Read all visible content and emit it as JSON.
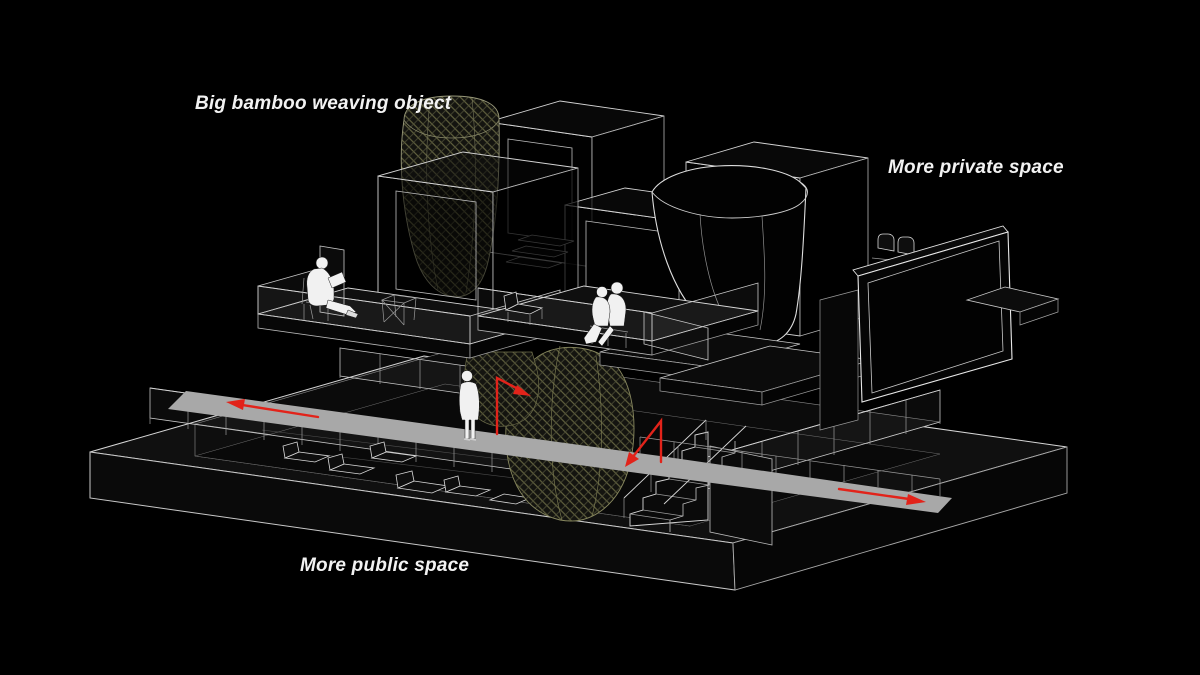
{
  "scene": {
    "type": "axonometric-architecture-diagram",
    "labels": {
      "bamboo_object": "Big bamboo weaving object",
      "private_space": "More private space",
      "public_space": "More public space"
    },
    "colors": {
      "background": "#000000",
      "wireframe": "#d4d4d4",
      "walkway": "#a8a8a8",
      "arrow": "#e2231a",
      "weave_line": "#6e6e46",
      "weave_fill": "#141410",
      "figure": "#f1f1f1"
    }
  }
}
